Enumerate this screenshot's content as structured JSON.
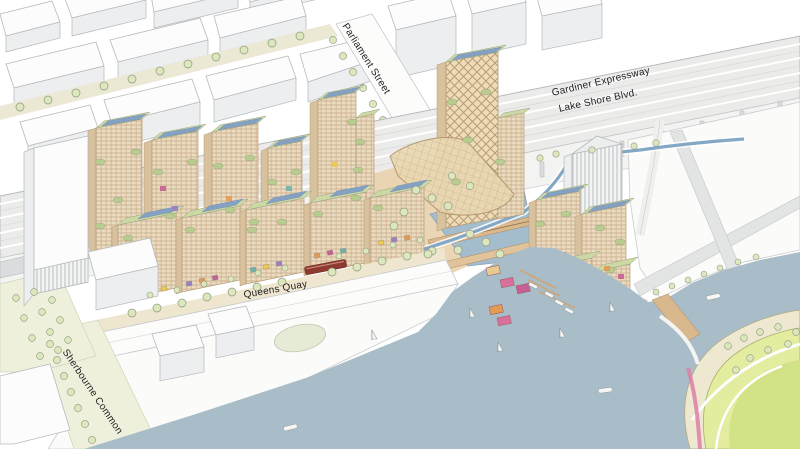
{
  "labels": {
    "parliament_street": "Parliament Street",
    "gardiner_expressway": "Gardiner Expressway",
    "lake_shore_blvd": "Lake Shore Blvd.",
    "queens_quay": "Queens Quay",
    "sherbourne_common": "Sherbourne Common"
  },
  "colors": {
    "background": "#ffffff",
    "label_text": "#1f1f21",
    "outline_gray": "#b6babd",
    "context_fill": "#fcfcfc",
    "context_shade": "#eceeef",
    "street_cream": "#ebe8d4",
    "park_green_cream": "#eff0dc",
    "expressway_gray": "#ebebea",
    "roadway_white": "#fcfcfb",
    "timber_tan": "#e9dcc0",
    "timber_shade": "#d8c29e",
    "window_line": "#c9ab8a",
    "roof_green": "#cdd9a4",
    "terrace_green": "#b9cc90",
    "solar_blue": "#84a1c4",
    "tree_green": "#dde7bc",
    "water_blue": "#a9bdc9",
    "ribbon_blue": "#7ba3c2",
    "plaza_tan": "#e8d2ae",
    "canopy_tan": "#e9d8b2",
    "island_sand": "#efe8d1",
    "island_green": "#e3ec9f",
    "island_lawn": "#d2e287",
    "accent_pink": "#d9709b",
    "accent_magenta": "#c75f94",
    "accent_purple": "#9a7fc2",
    "accent_orange": "#e39a54",
    "accent_teal": "#6fb3ab",
    "accent_yellow": "#ecc94f",
    "streetcar_red": "#8e3a31"
  }
}
